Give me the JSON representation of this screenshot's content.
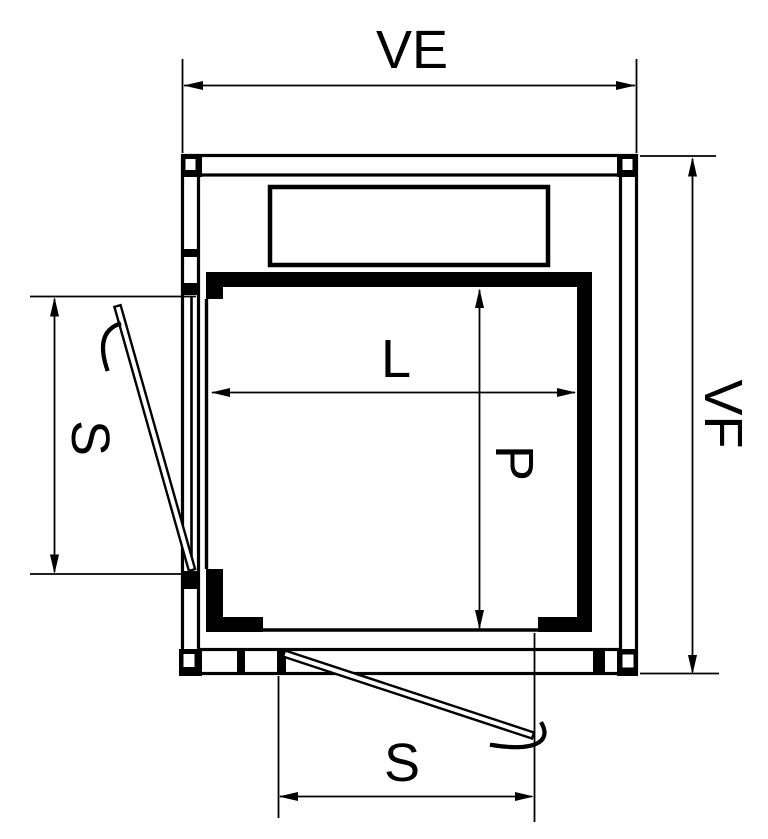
{
  "drawing": {
    "background_color": "#ffffff",
    "line_color": "#000000",
    "labels": {
      "overall_width": "VE",
      "overall_depth": "VF",
      "car_width": "L",
      "car_depth": "P",
      "side_opening": "S",
      "front_opening": "S"
    }
  }
}
